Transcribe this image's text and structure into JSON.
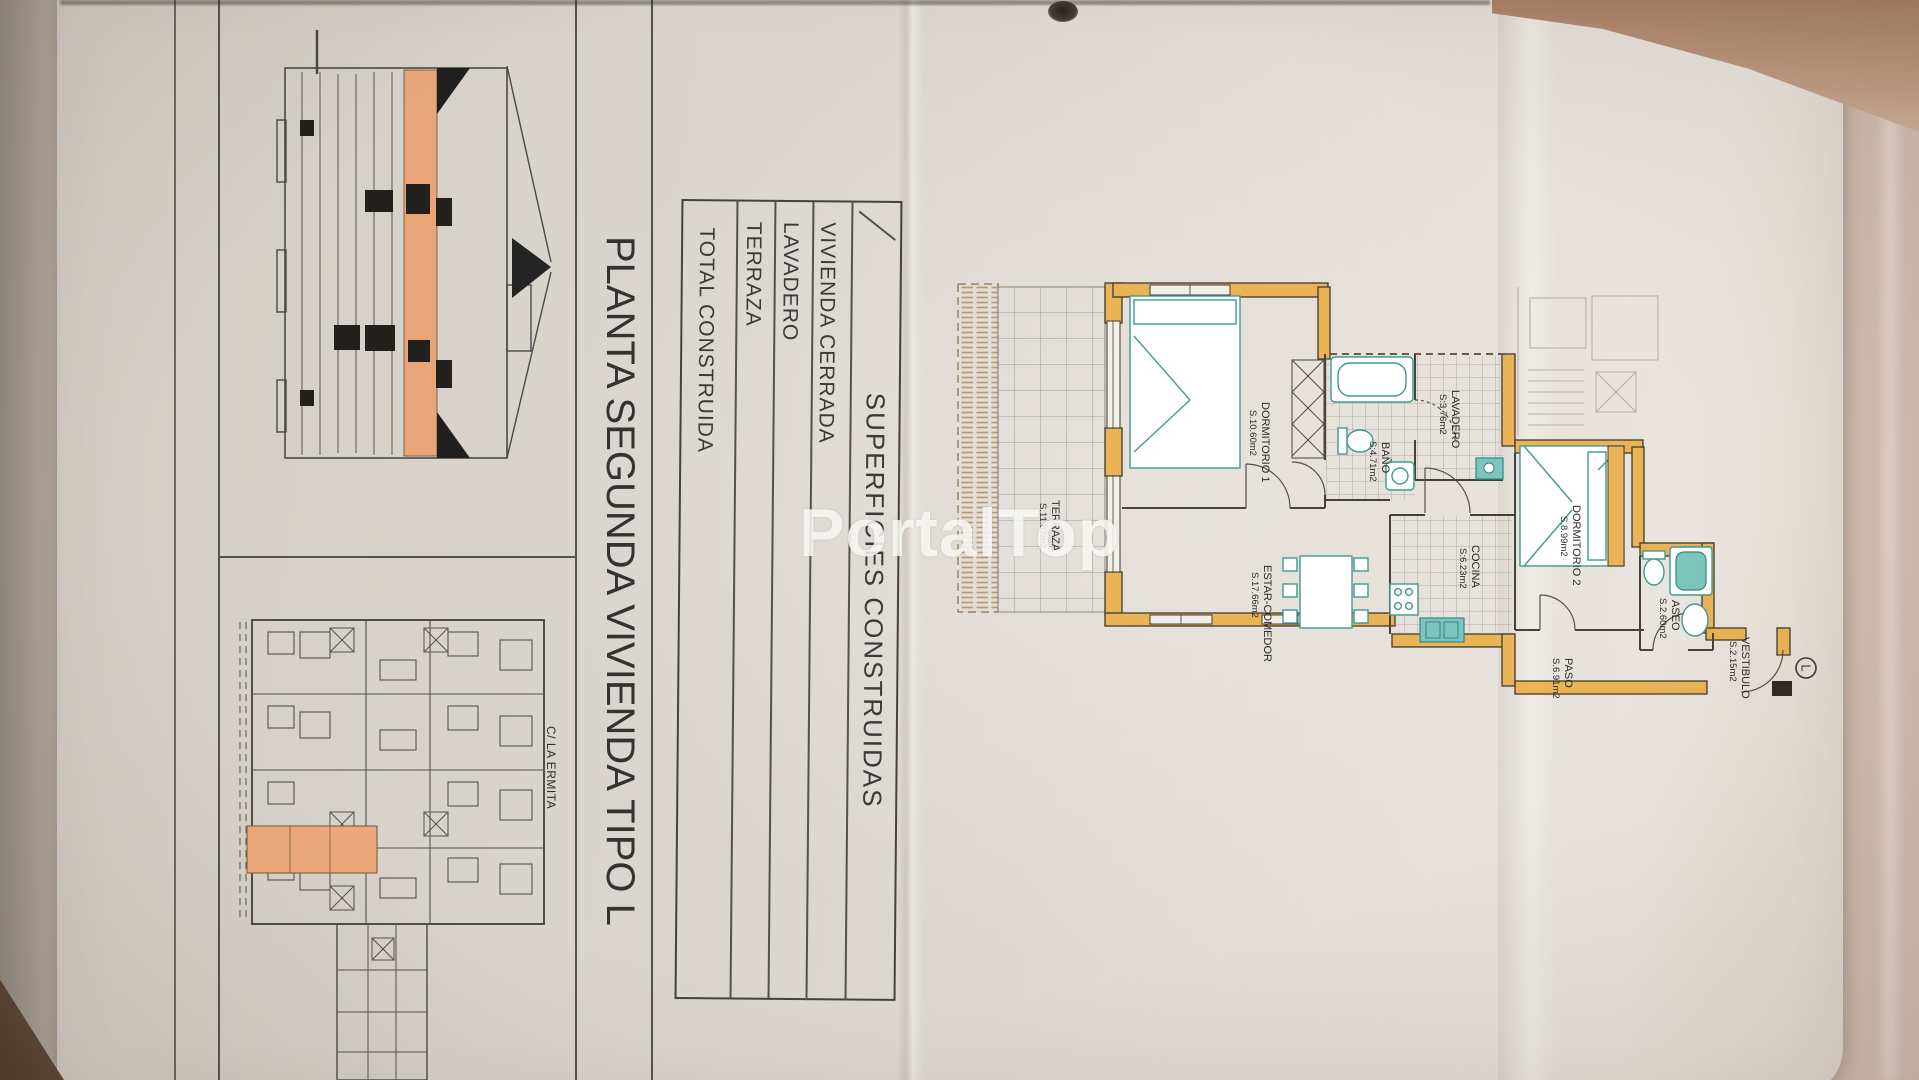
{
  "watermark": "PortalTop",
  "sheet": {
    "title": "PLANTA SEGUNDA VIVIENDA TIPO L",
    "street_label": "C/ LA ERMITA",
    "unit_type_badge": "L"
  },
  "surfaces_table": {
    "header": "SUPERFICIES CONSTRUIDAS",
    "rows": [
      {
        "label": "VIVIENDA CERRADA",
        "value": "67.50 m2"
      },
      {
        "label": "LAVADERO",
        "value": "4.74 m2"
      },
      {
        "label": "TERRAZA",
        "value": "12.97 m2"
      }
    ],
    "total": {
      "label": "TOTAL CONSTRUIDA",
      "value": "85.21 m2"
    }
  },
  "floor_plan": {
    "rooms": [
      {
        "name": "TERRAZA",
        "area": "S.11.87m2"
      },
      {
        "name": "DORMITORIO 1",
        "area": "S.10.60m2"
      },
      {
        "name": "BAÑO",
        "area": "S:4.71m2"
      },
      {
        "name": "LAVADERO",
        "area": "S:3.76m2"
      },
      {
        "name": "COCINA",
        "area": "S:6.23m2"
      },
      {
        "name": "ESTAR-COMEDOR",
        "area": "S.17.66m2"
      },
      {
        "name": "DORMITORIO 2",
        "area": "S.8.99m2"
      },
      {
        "name": "ASEO",
        "area": "S.2.60m2"
      },
      {
        "name": "PASO",
        "area": "S.6.91m2"
      },
      {
        "name": "VESTIBULO",
        "area": "S.2.15m2"
      }
    ]
  },
  "colors": {
    "wall_accent": "#eab354",
    "highlight_orange": "#eba87c",
    "fixture_teal": "#7cc4bd",
    "paper": "#ddd8d1",
    "background": "#d3bcb0"
  }
}
